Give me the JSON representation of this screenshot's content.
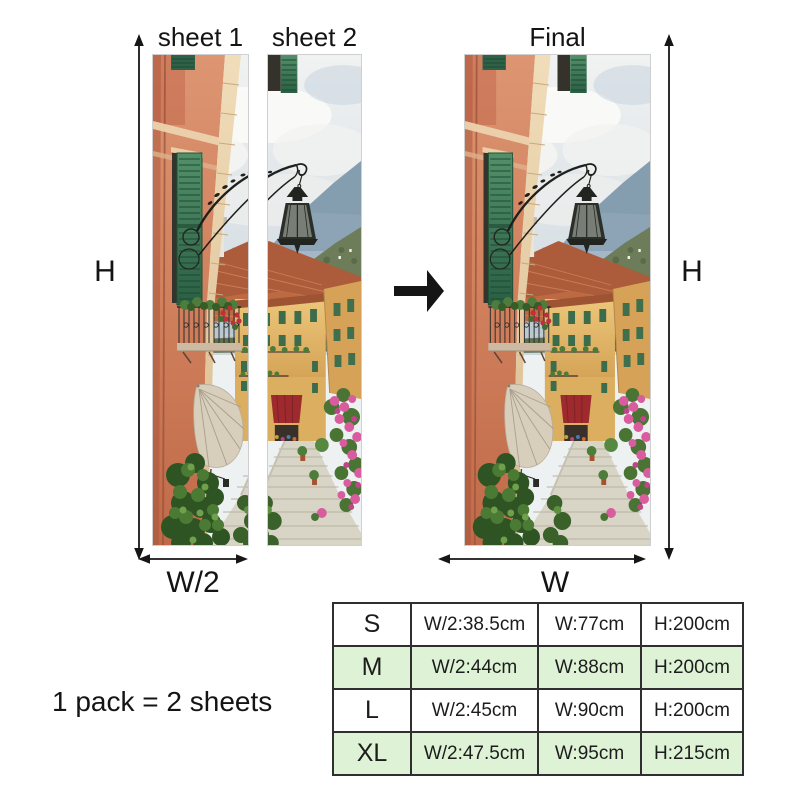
{
  "labels": {
    "sheet1": "sheet 1",
    "sheet2": "sheet 2",
    "final": "Final",
    "h_left": "H",
    "h_right": "H",
    "w_half": "W/2",
    "w_full": "W",
    "pack_note": "1 pack = 2 sheets"
  },
  "size_table": {
    "rows": [
      {
        "size": "S",
        "w_half": "W/2:38.5cm",
        "w": "W:77cm",
        "h": "H:200cm",
        "highlight": false
      },
      {
        "size": "M",
        "w_half": "W/2:44cm",
        "w": "W:88cm",
        "h": "H:200cm",
        "highlight": true
      },
      {
        "size": "L",
        "w_half": "W/2:45cm",
        "w": "W:90cm",
        "h": "H:200cm",
        "highlight": false
      },
      {
        "size": "XL",
        "w_half": "W/2:47.5cm",
        "w": "W:95cm",
        "h": "H:215cm",
        "highlight": true
      }
    ]
  },
  "colors": {
    "arrow": "#161616",
    "table_border": "#2f2f2f",
    "row_highlight": "#def3d6",
    "background": "#ffffff"
  },
  "icons": [
    "up-down-arrow-icon",
    "left-right-arrow-icon",
    "combine-right-arrow-icon"
  ]
}
